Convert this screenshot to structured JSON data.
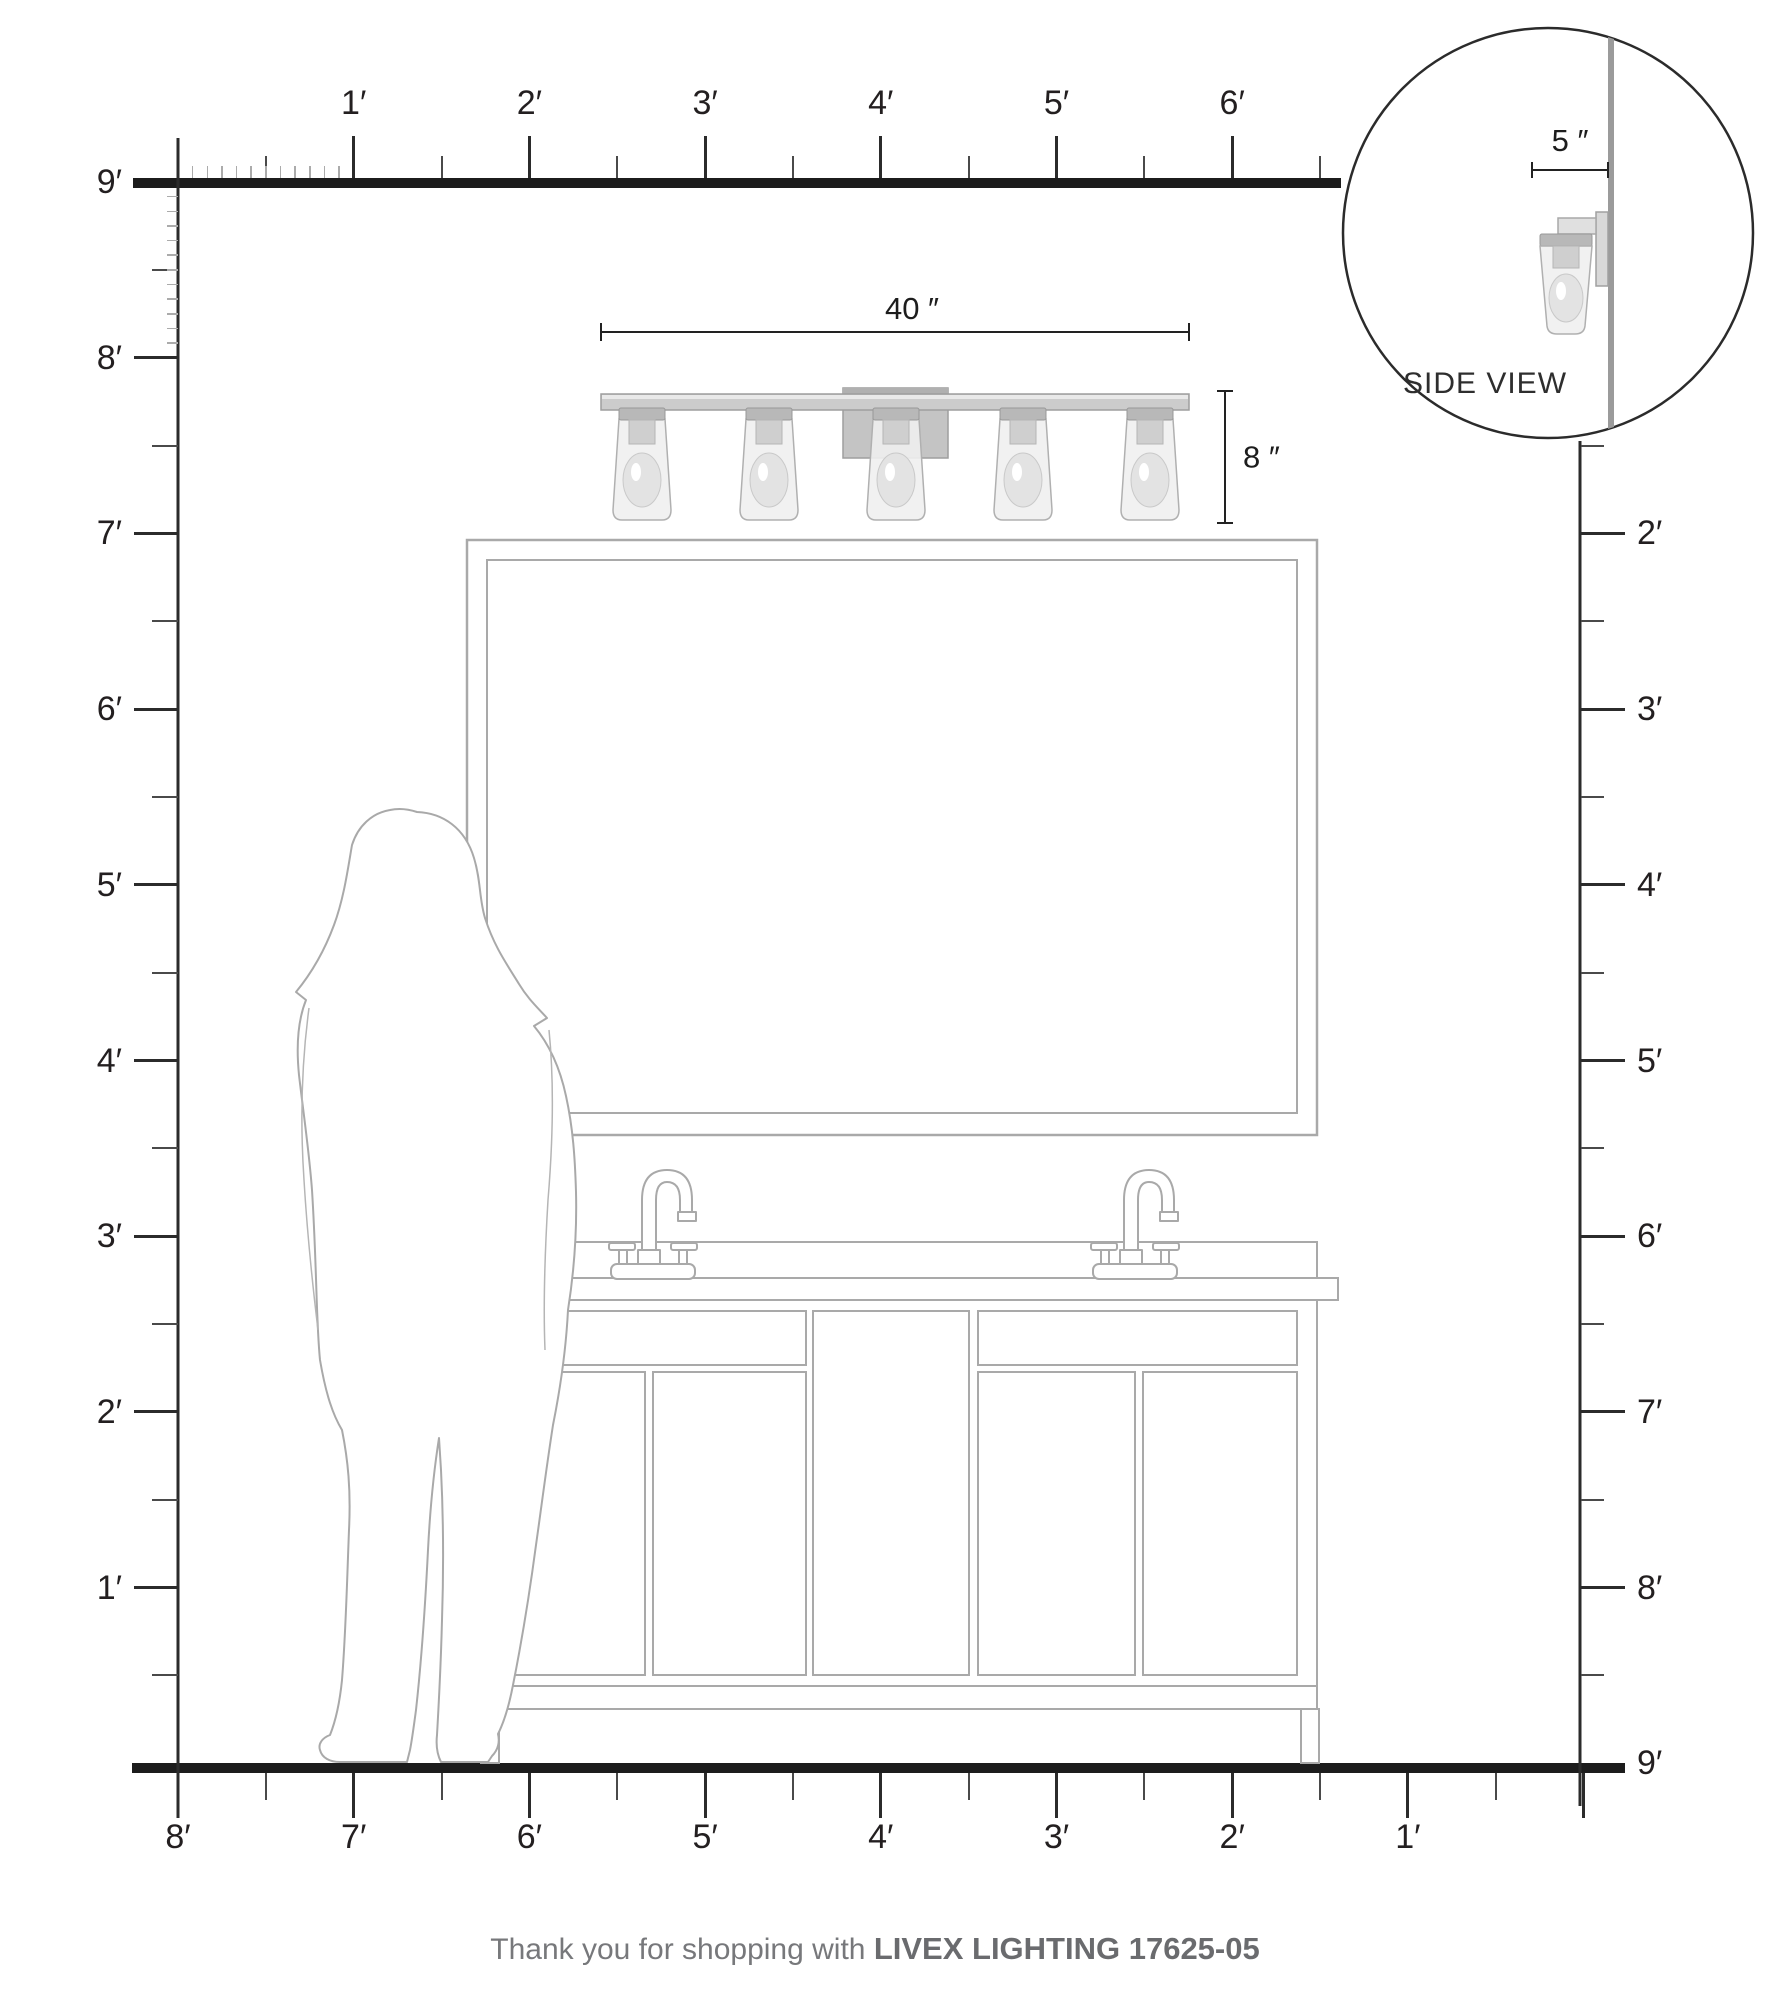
{
  "rulers": {
    "top": {
      "labels": [
        "1′",
        "2′",
        "3′",
        "4′",
        "5′",
        "6′"
      ]
    },
    "left": {
      "labels": [
        "9′",
        "8′",
        "7′",
        "6′",
        "5′",
        "4′",
        "3′",
        "2′",
        "1′"
      ]
    },
    "right": {
      "labels": [
        "2′",
        "3′",
        "4′",
        "5′",
        "6′",
        "7′",
        "8′",
        "9′"
      ]
    },
    "bottom": {
      "labels": [
        "8′",
        "7′",
        "6′",
        "5′",
        "4′",
        "3′",
        "2′",
        "1′"
      ]
    }
  },
  "dimensions": {
    "fixture_width": "40 ″",
    "fixture_height": "8 ″",
    "fixture_depth": "5 ″"
  },
  "side_view": {
    "label": "SIDE VIEW"
  },
  "footer": {
    "prefix": "Thank you for shopping with ",
    "brand": "LIVEX LIGHTING 17625-05"
  },
  "colors": {
    "ink": "#231f20",
    "structure_line": "#1c1c1c",
    "outline_gray": "#a9a9a9",
    "metal_gray": "#c9c9c9",
    "wall_gray": "#9b9b9b",
    "footer_gray": "#6d6e70"
  }
}
